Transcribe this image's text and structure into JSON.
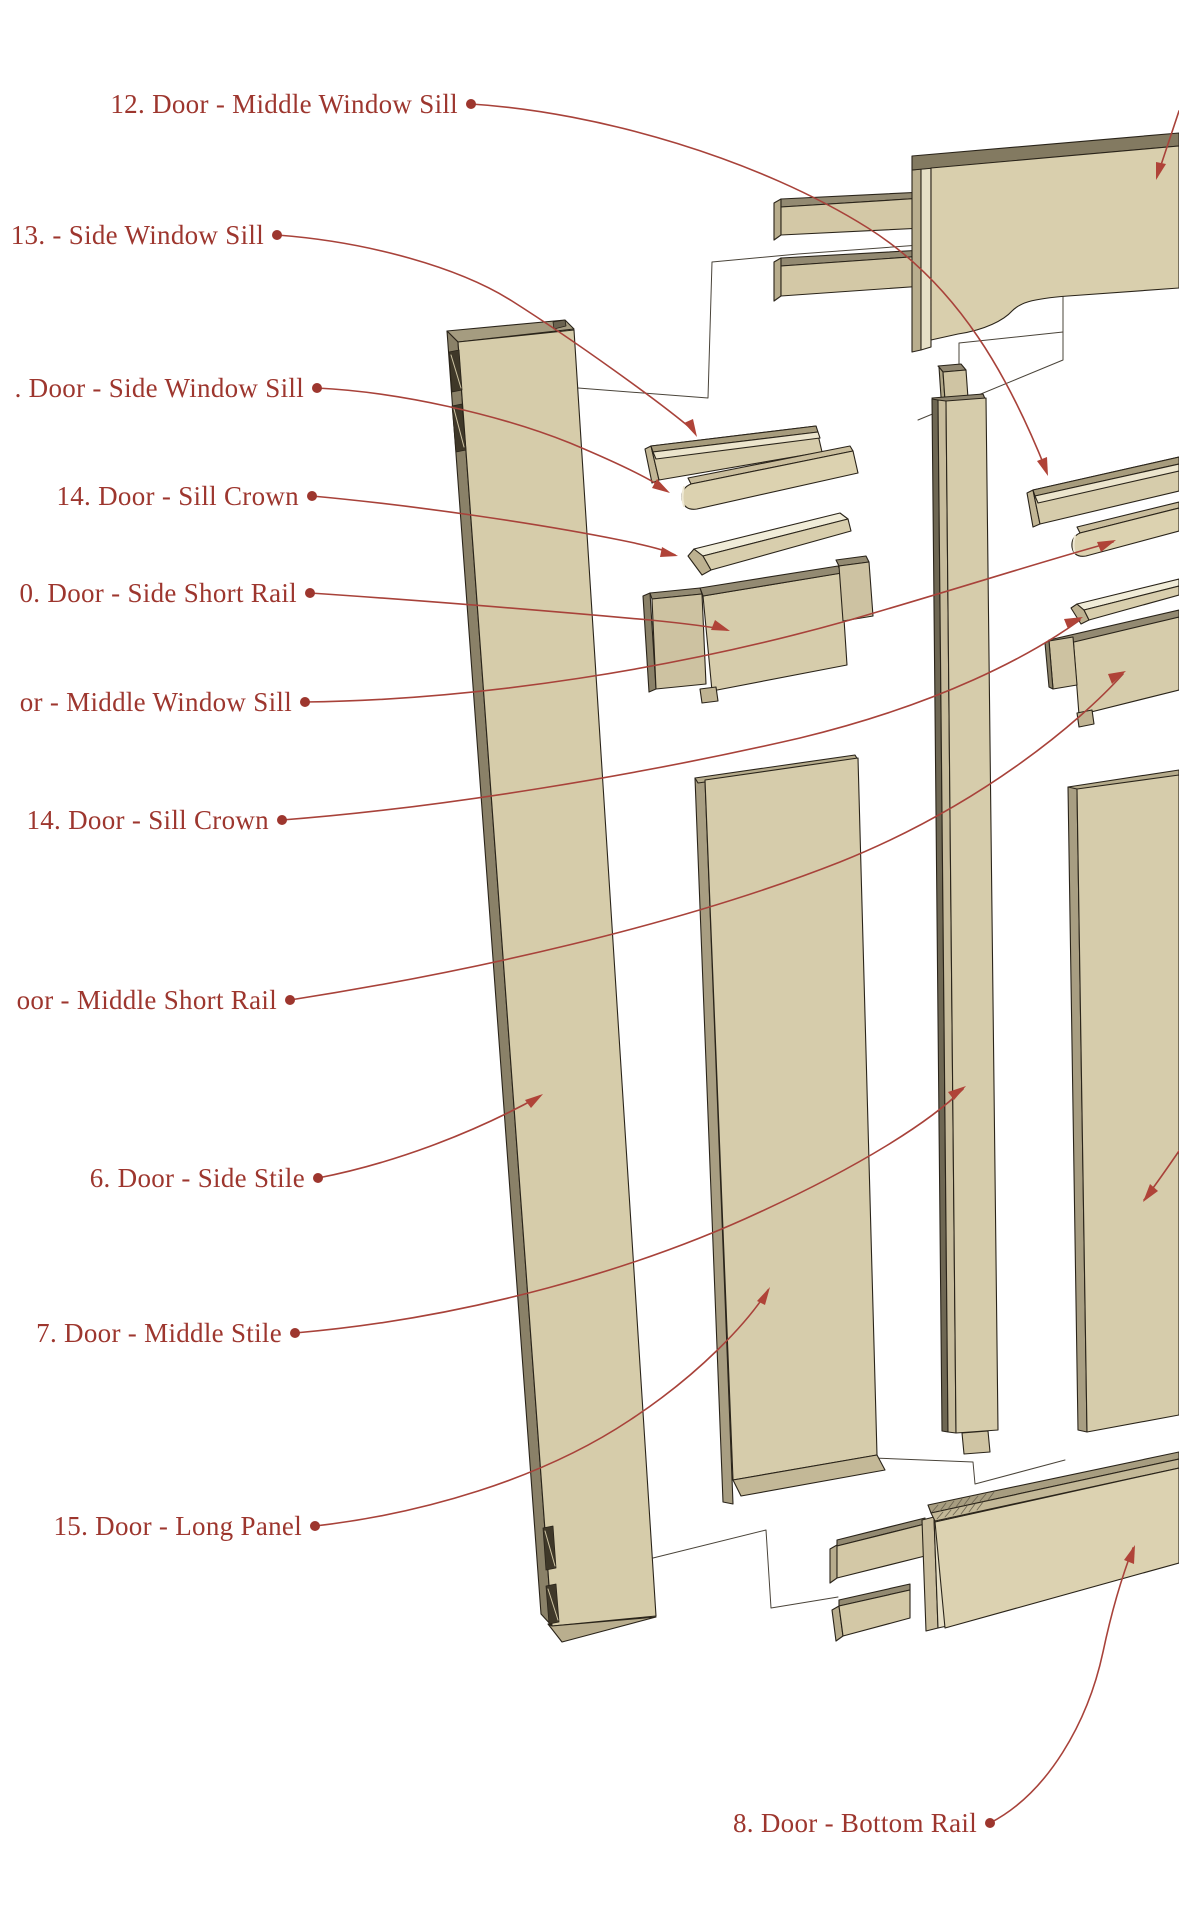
{
  "figure": {
    "type": "exploded-assembly-diagram",
    "subject": "Door components",
    "background": "#ffffff"
  },
  "colors": {
    "label_text": "#9d362e",
    "leader_line": "#a8423a",
    "leader_dot": "#9d362e",
    "wood_face": "#d6ccaa",
    "wood_top_shadow": "#938a72",
    "wood_side_light": "#e6dfc6",
    "wood_side_dark": "#8a8168",
    "crown_highlight": "#f0ecd8",
    "ghost_outline": "#4a443a",
    "part_outline": "#2a241a"
  },
  "labels": [
    {
      "text": "12. Door - Middle Window Sill"
    },
    {
      "text": "13. - Side Window Sill"
    },
    {
      "text": ". Door - Side Window Sill"
    },
    {
      "text": "14. Door - Sill Crown"
    },
    {
      "text": "0. Door - Side Short Rail"
    },
    {
      "text": "or - Middle Window Sill"
    },
    {
      "text": "14. Door - Sill Crown"
    },
    {
      "text": "oor - Middle Short Rail"
    },
    {
      "text": "6. Door - Side Stile"
    },
    {
      "text": "7. Door - Middle Stile"
    },
    {
      "text": "15. Door - Long Panel"
    },
    {
      "text": "8. Door - Bottom Rail"
    }
  ],
  "parts": [
    "top-rail",
    "side-stile-left",
    "side-window-sill-grooved",
    "side-window-sill",
    "sill-crown-left",
    "side-short-rail",
    "long-panel",
    "middle-stile",
    "middle-window-sill-grooved",
    "middle-window-sill",
    "sill-crown-right",
    "middle-short-rail",
    "side-stile-right",
    "bottom-rail"
  ]
}
